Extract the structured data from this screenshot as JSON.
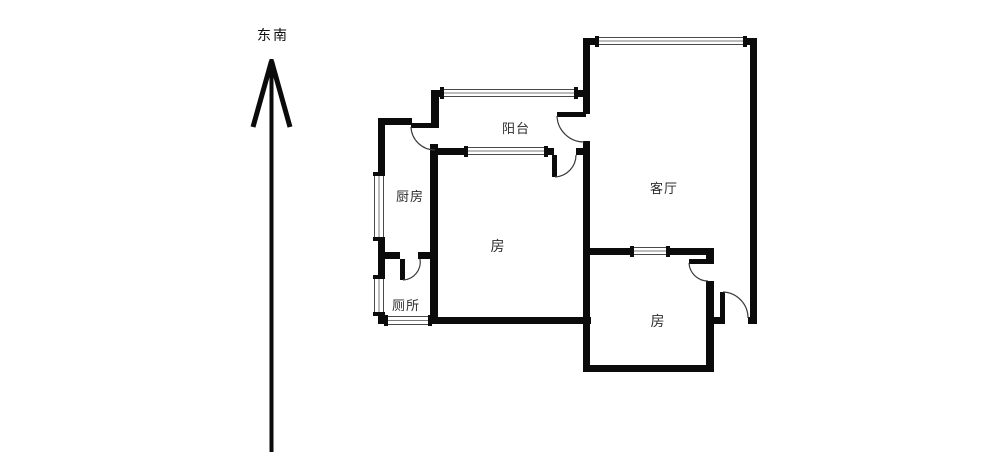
{
  "compass": {
    "direction_label": "东南"
  },
  "floorplan": {
    "rooms": [
      {
        "id": "balcony",
        "label": "阳台"
      },
      {
        "id": "kitchen",
        "label": "厨房"
      },
      {
        "id": "living-room",
        "label": "客厅"
      },
      {
        "id": "bedroom-center",
        "label": "房"
      },
      {
        "id": "toilet",
        "label": "厕所"
      },
      {
        "id": "bedroom-south",
        "label": "房"
      }
    ]
  },
  "colors": {
    "wall": "#0b0b0b",
    "door_arc": "#3a3a3a",
    "window_line": "#4a4a4a",
    "label_text": "#2d2d2d",
    "background": "#ffffff"
  }
}
